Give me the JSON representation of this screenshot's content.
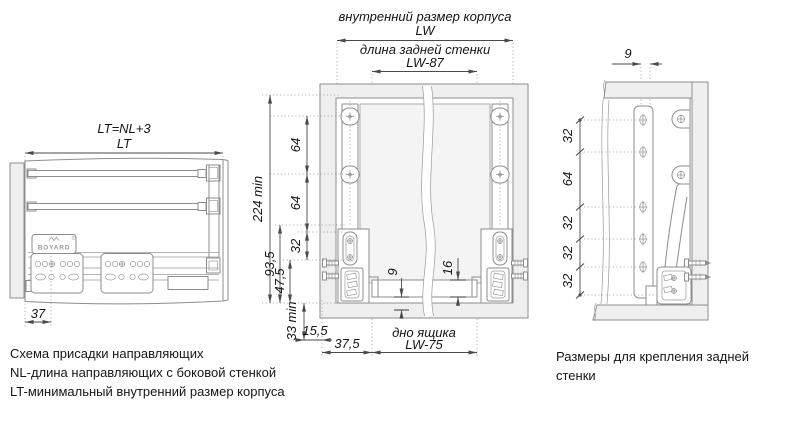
{
  "colors": {
    "line": "#8d8d8d",
    "wall_fill": "#efefef",
    "dim_text": "#141414",
    "background": "#ffffff"
  },
  "left_view": {
    "formula_label": "LT=NL+3",
    "lt_label": "LT",
    "dim_37": "37",
    "brand": "BOYARD",
    "brand_reg": "®"
  },
  "middle_view": {
    "inner_width_label": "внутренний размер корпуса",
    "lw_label": "LW",
    "back_wall_label": "длина задней стенки",
    "lw87_label": "LW-87",
    "dim_224": "224 min",
    "dim_64a": "64",
    "dim_64b": "64",
    "dim_32": "32",
    "dim_93_5": "93,5",
    "dim_47_5": "47,5",
    "dim_33": "33 min",
    "dim_15_5": "15,5",
    "dim_37_5": "37,5",
    "dim_9": "9",
    "dim_16": "16",
    "bottom_label": "дно ящика",
    "lw75_label": "LW-75"
  },
  "right_view": {
    "dim_9": "9",
    "dims": [
      "32",
      "64",
      "32",
      "32",
      "32"
    ]
  },
  "captions": {
    "left_lines": [
      "Схема присадки направляющих",
      "NL-длина направляющих с боковой стенкой",
      "LT-минимальный внутренний размер корпуса"
    ],
    "right_lines": [
      "Размеры для крепления задней",
      "стенки"
    ]
  }
}
